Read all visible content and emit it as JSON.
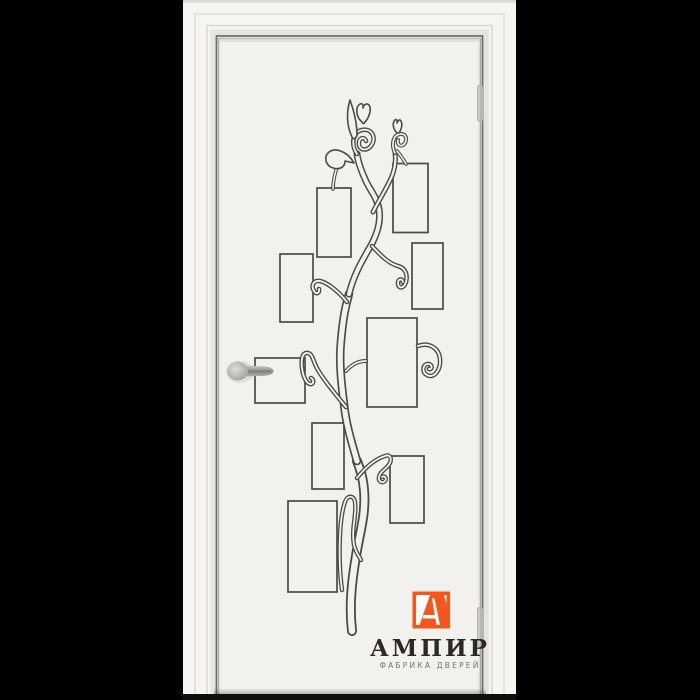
{
  "background_color": "#000000",
  "brand": {
    "logo_letter": "А",
    "name": "АМПИР",
    "tagline": "ФАБРИКА ДВЕРЕЙ",
    "accent_color": "#F4561C",
    "name_color": "#2C2924",
    "tagline_color": "#78756E"
  },
  "door": {
    "casing_color": "#F6F5F2",
    "leaf_color": "#F2F1EE",
    "design_line_color": "#4B4A46",
    "gap_line_color": "#6F6D68",
    "hardware_color": "#B8B6B2",
    "photo_frames": [
      {
        "x": 317,
        "y": 188,
        "w": 34,
        "h": 69
      },
      {
        "x": 393,
        "y": 163.5,
        "w": 35,
        "h": 69
      },
      {
        "x": 280,
        "y": 254,
        "w": 33,
        "h": 68
      },
      {
        "x": 412,
        "y": 243,
        "w": 31,
        "h": 66
      },
      {
        "x": 367,
        "y": 318,
        "w": 50,
        "h": 89
      },
      {
        "x": 255,
        "y": 358,
        "w": 50,
        "h": 45
      },
      {
        "x": 312,
        "y": 423,
        "w": 32,
        "h": 66
      },
      {
        "x": 390,
        "y": 456,
        "w": 34,
        "h": 67
      },
      {
        "x": 288,
        "y": 501,
        "w": 49,
        "h": 91
      }
    ]
  }
}
